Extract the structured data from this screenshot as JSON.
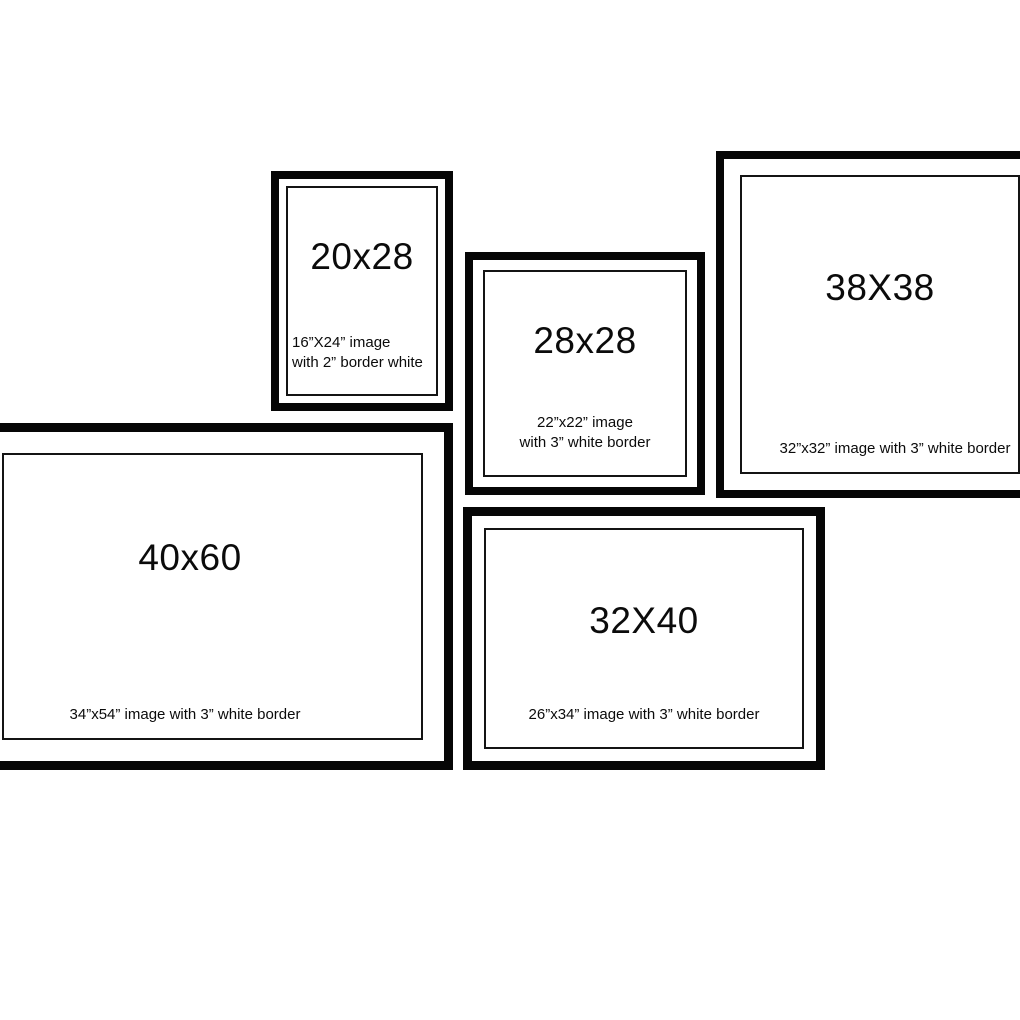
{
  "title": "Picture frame size comparison diagram",
  "colors": {
    "background": "#ffffff",
    "frame_border": "#060606",
    "inner_line": "#141414",
    "text": "#0b0b0b"
  },
  "frames": [
    {
      "id": "frame-20x28",
      "label": "20x28",
      "description": "16”X24” image\nwith 2” border white"
    },
    {
      "id": "frame-28x28",
      "label": "28x28",
      "description": "22”x22” image\nwith 3” white border"
    },
    {
      "id": "frame-38x38",
      "label": "38X38",
      "description": "32”x32” image with 3” white border"
    },
    {
      "id": "frame-40x60",
      "label": "40x60",
      "description": "34”x54” image with 3” white border"
    },
    {
      "id": "frame-32x40",
      "label": "32X40",
      "description": "26”x34” image with 3” white border"
    }
  ]
}
